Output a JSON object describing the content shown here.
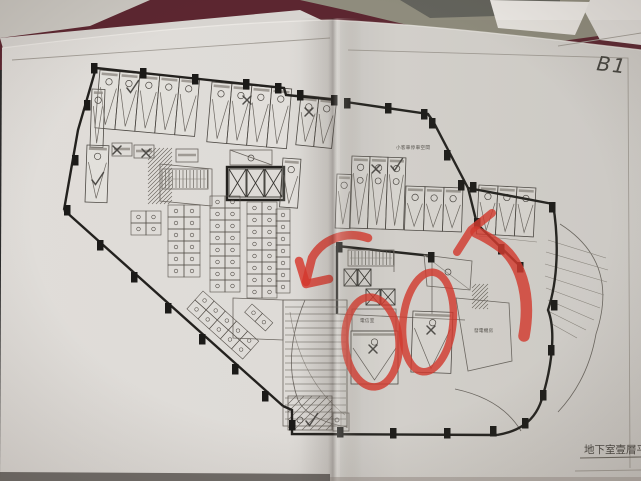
{
  "scene": {
    "type": "photograph of a folded blueprint sheet lying on a table",
    "surface_color": "#5c2630",
    "fabric_color": "#8f8c7d",
    "paper_color": "#dcd9d5"
  },
  "sheet": {
    "handwritten_label": "B1",
    "title_block_text": "地下室壹層平"
  },
  "plan": {
    "room_labels": {
      "telecom_room": "電信室",
      "generator_room": "發電機房",
      "car_parking_zone": "小客車停車空間"
    }
  },
  "annotations": {
    "marker_color": "#d7372c",
    "pencil_color": "#3f3d3a",
    "red_marks": [
      {
        "shape": "oval",
        "over": "parking space with pencil cross"
      },
      {
        "shape": "oval",
        "over": "parking space with pencil cross"
      },
      {
        "shape": "arrow",
        "pointing": "down-left toward the ramp"
      },
      {
        "shape": "arrow",
        "pointing": "up-left from the driveway"
      }
    ],
    "pencil_marks": {
      "check": "✓",
      "cross": "✗"
    }
  }
}
